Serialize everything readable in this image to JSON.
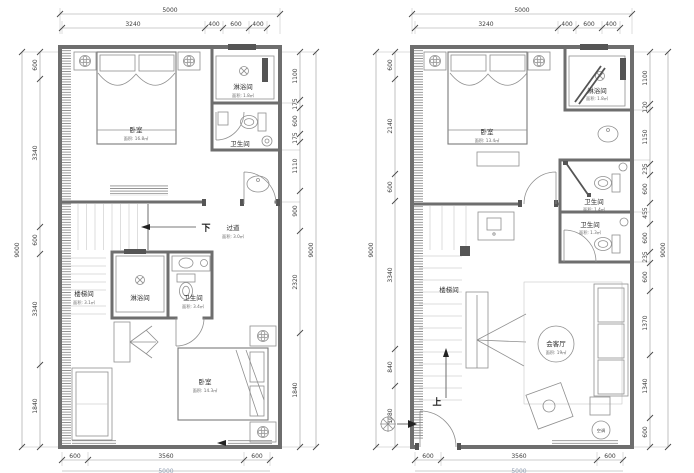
{
  "left_plan": {
    "rooms": {
      "bedroom_top": {
        "name": "卧室",
        "area": "面积: 16.8㎡"
      },
      "shower_top": {
        "name": "淋浴间",
        "area": "面积: 1.8㎡"
      },
      "wc_top": {
        "name": "卫生间"
      },
      "down": "下",
      "corridor": {
        "name": "过道",
        "area": "面积: 3.0㎡"
      },
      "stairwell": {
        "name": "楼梯间",
        "area": "面积: 3.1㎡"
      },
      "shower_mid": {
        "name": "淋浴间"
      },
      "wc_mid": {
        "name": "卫生间",
        "area": "面积: 3.4㎡"
      },
      "bedroom_bottom": {
        "name": "卧室",
        "area": "面积: 14.3㎡"
      }
    },
    "dims": {
      "top_total": "5000",
      "top_segments": [
        "3240",
        "400",
        "600",
        "400"
      ],
      "left_total": "9000",
      "left_segments": [
        "600",
        "3340",
        "600",
        "3340",
        "1840"
      ],
      "right_total": "9000",
      "right_segments": [
        "1100",
        "175",
        "600",
        "175",
        "1110",
        "900",
        "2320",
        "1840"
      ],
      "bottom_segments": [
        "600",
        "3560",
        "600"
      ],
      "bottom_total": "5000"
    }
  },
  "right_plan": {
    "rooms": {
      "bedroom": {
        "name": "卧室",
        "area": "面积: 13.4㎡"
      },
      "shower": {
        "name": "淋浴间",
        "area": "面积: 1.8㎡"
      },
      "wc_upper": {
        "name": "卫生间",
        "area": "面积: 1.4㎡"
      },
      "wc_lower": {
        "name": "卫生间",
        "area": "面积: 1.3㎡"
      },
      "stairwell": {
        "name": "楼梯间"
      },
      "up": "上",
      "living": {
        "name": "会客厅",
        "area": "面积: 19㎡"
      },
      "ac": "空调"
    },
    "dims": {
      "top_total": "5000",
      "top_segments": [
        "3240",
        "400",
        "600",
        "400"
      ],
      "left_total": "9000",
      "left_segments": [
        "600",
        "2140",
        "600",
        "3340",
        "840",
        "1080"
      ],
      "right_total": "9000",
      "right_segments": [
        "1100",
        "120",
        "1150",
        "235",
        "600",
        "455",
        "600",
        "235",
        "600",
        "1370",
        "1340",
        "600"
      ],
      "bottom_segments": [
        "600",
        "3560",
        "600"
      ],
      "bottom_total": "5000"
    }
  }
}
